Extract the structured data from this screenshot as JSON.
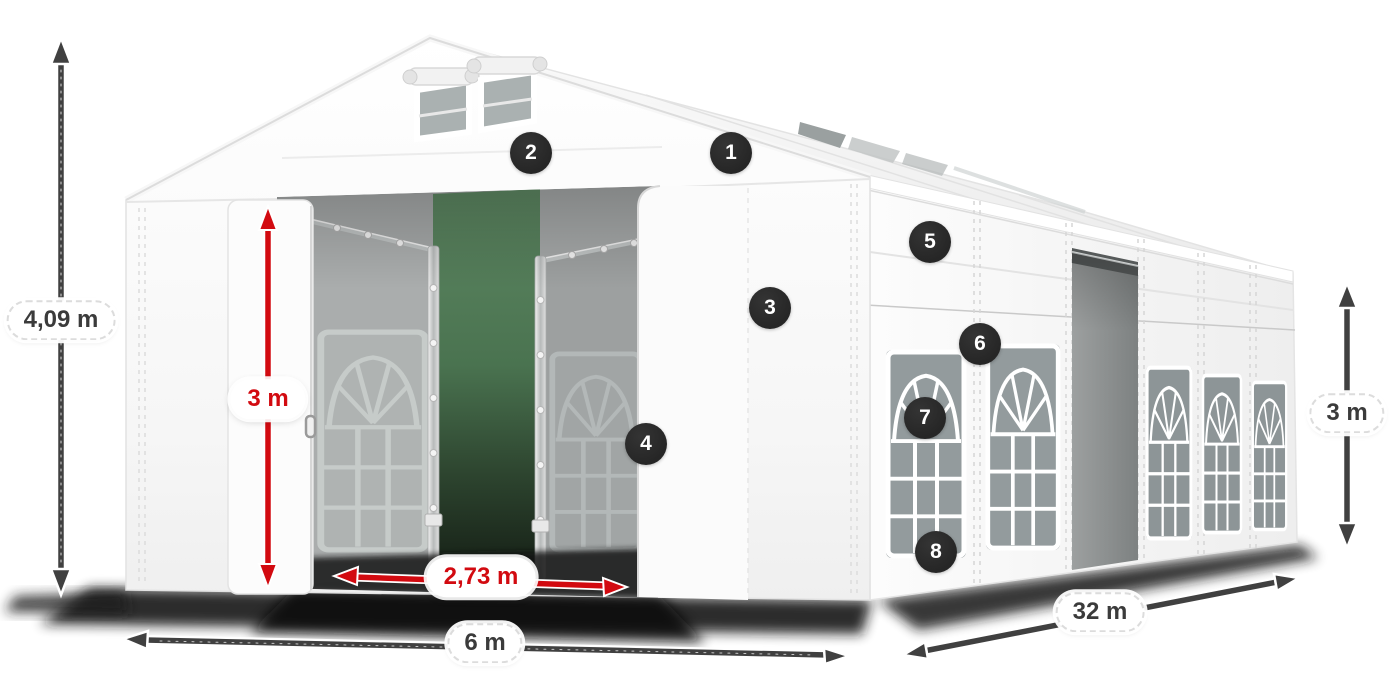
{
  "title": "Marquee tent dimension diagram",
  "colors": {
    "accent_red": "#d20a10",
    "arrow_dark": "#404040",
    "badge_bg": "#282828",
    "badge_text": "#ffffff",
    "tent_white": "#f8f8f8",
    "backdrop_green": "#4a7350"
  },
  "dimensions": [
    {
      "id": "total-height",
      "label": "4,09 m",
      "style": "dark"
    },
    {
      "id": "entrance-height",
      "label": "3 m",
      "style": "red"
    },
    {
      "id": "entrance-width",
      "label": "2,73 m",
      "style": "red"
    },
    {
      "id": "front-width",
      "label": "6 m",
      "style": "dark"
    },
    {
      "id": "side-length",
      "label": "32 m",
      "style": "dark"
    },
    {
      "id": "side-height",
      "label": "3 m",
      "style": "dark"
    }
  ],
  "callouts": [
    {
      "number": "1"
    },
    {
      "number": "2"
    },
    {
      "number": "3"
    },
    {
      "number": "4"
    },
    {
      "number": "5"
    },
    {
      "number": "6"
    },
    {
      "number": "7"
    },
    {
      "number": "8"
    }
  ]
}
